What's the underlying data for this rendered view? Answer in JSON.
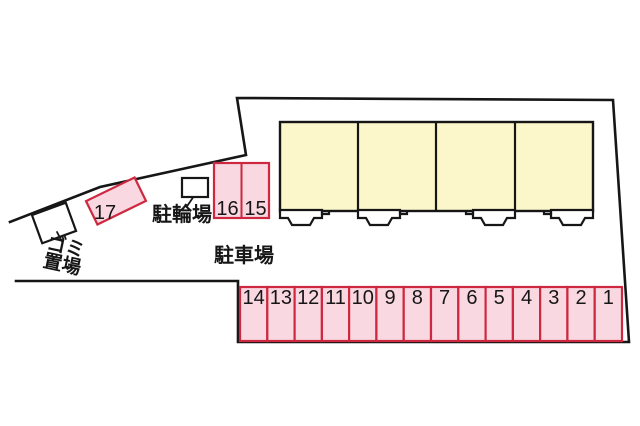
{
  "labels": {
    "garbage_line1": "ゴミ",
    "garbage_line2": "置場",
    "bicycle_parking": "駐輪場",
    "car_parking": "駐車場"
  },
  "spaces": {
    "row": [
      "14",
      "13",
      "12",
      "11",
      "10",
      "9",
      "8",
      "7",
      "6",
      "5",
      "4",
      "3",
      "2",
      "1"
    ],
    "pair": [
      "16",
      "15"
    ],
    "single": "17"
  },
  "colors": {
    "space-fill": "#f9d8e1",
    "space-border": "#cd2840",
    "building-fill": "#fbf7ca",
    "line-color": "#161616",
    "background": "#ffffff"
  }
}
